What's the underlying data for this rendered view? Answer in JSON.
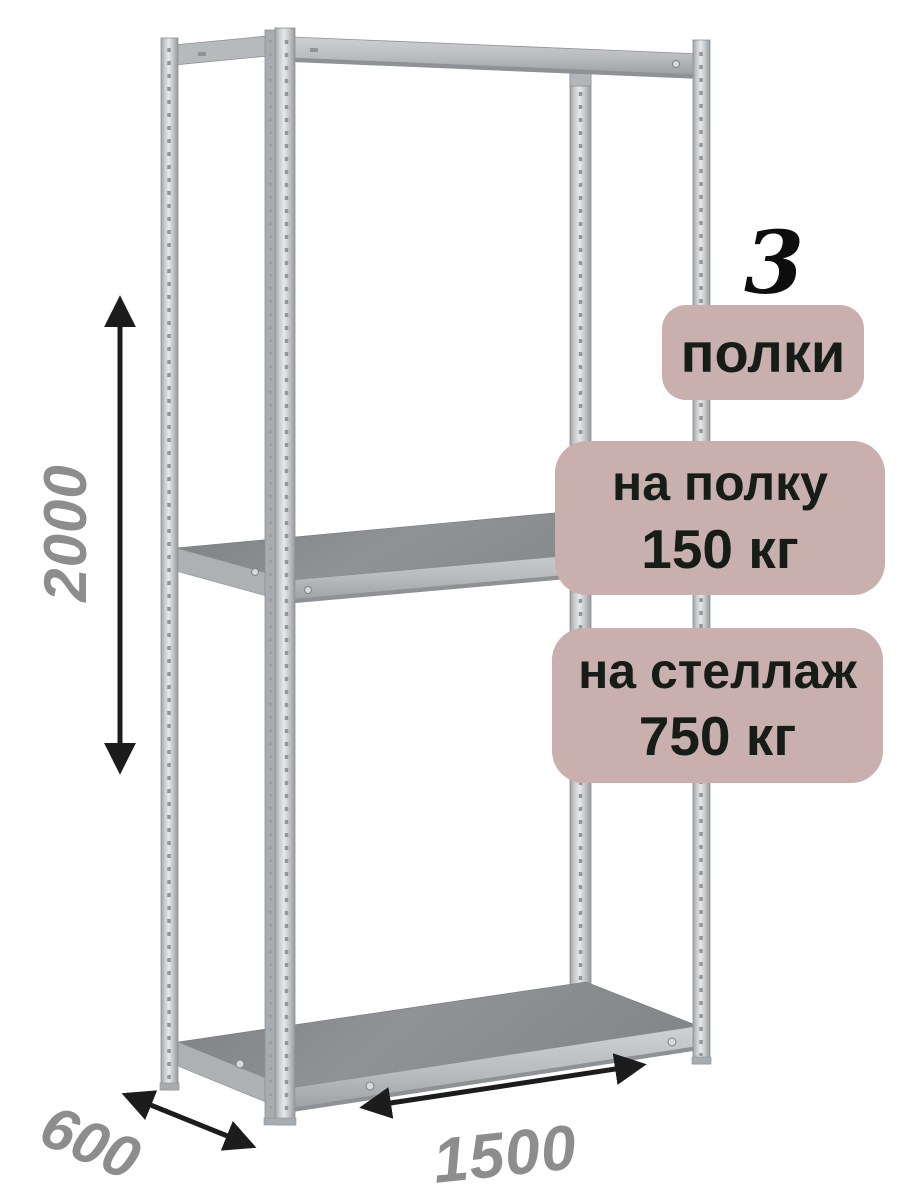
{
  "annotations": {
    "shelf_count": "3",
    "shelf_count_label": "полки",
    "per_shelf_line1": "на полку",
    "per_shelf_line2": "150 кг",
    "per_rack_line1": "на стеллаж",
    "per_rack_line2": "750 кг"
  },
  "dimensions": {
    "height": "2000",
    "depth": "600",
    "width": "1500"
  },
  "colors": {
    "background": "#ffffff",
    "badge_background": "#c9afae",
    "badge_text": "#161d17",
    "dimension_text": "#8d8d8d",
    "arrow": "#1c1c1c",
    "metal_highlight": "#e6e8e9",
    "metal_light": "#c6c8ca",
    "metal_mid": "#b9bcbe",
    "metal_dark": "#8f9295",
    "shelf_top": "#888b8e"
  }
}
